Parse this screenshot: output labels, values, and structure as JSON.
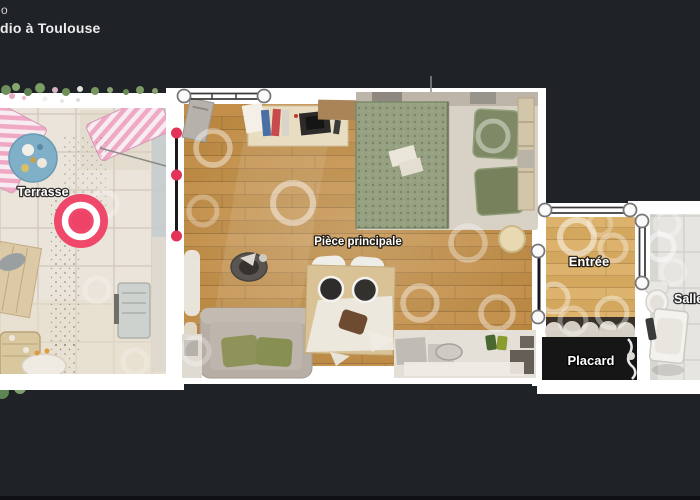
{
  "header": {
    "brand_fragment": "o",
    "title_fragment": "dio à Toulouse"
  },
  "floorplan": {
    "rooms": {
      "terrasse": {
        "label": "Terrasse"
      },
      "piece_principale": {
        "label": "Pièce principale"
      },
      "entree": {
        "label": "Entrée"
      },
      "placard": {
        "label": "Placard"
      },
      "salle": {
        "label": "Salle"
      }
    },
    "colors": {
      "background": "#1f2227",
      "wall": "#ffffff",
      "marker": "#ee4266",
      "node_dot": "#e23358",
      "wood_main": "#b9863f",
      "wood_entree": "#d4a75f",
      "terrace_tile": "#eae4da",
      "bath_tile": "#e7e5e1",
      "placard_fill": "#161616"
    }
  }
}
